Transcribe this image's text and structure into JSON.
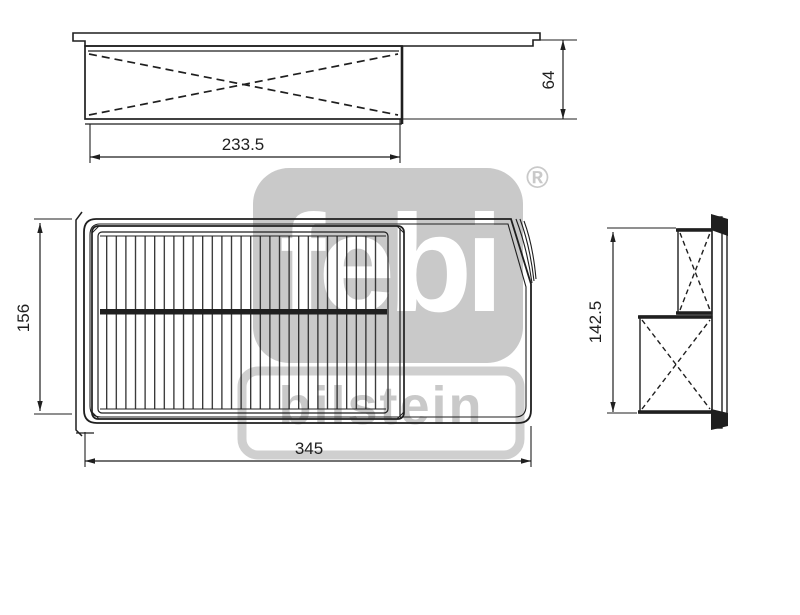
{
  "title": "Air filter technical drawing",
  "watermark": {
    "brand": "febi",
    "registered_mark": "®",
    "sub_brand": "bilstein"
  },
  "dimensions": {
    "top_view_width_mm": "233.5",
    "top_view_height_mm": "64",
    "front_view_height_mm": "156",
    "front_view_width_mm": "345",
    "side_view_height_mm": "142.5"
  },
  "colors": {
    "line": "#1f1f1f",
    "watermark_gray": "#c9c9c9",
    "background": "#ffffff"
  }
}
